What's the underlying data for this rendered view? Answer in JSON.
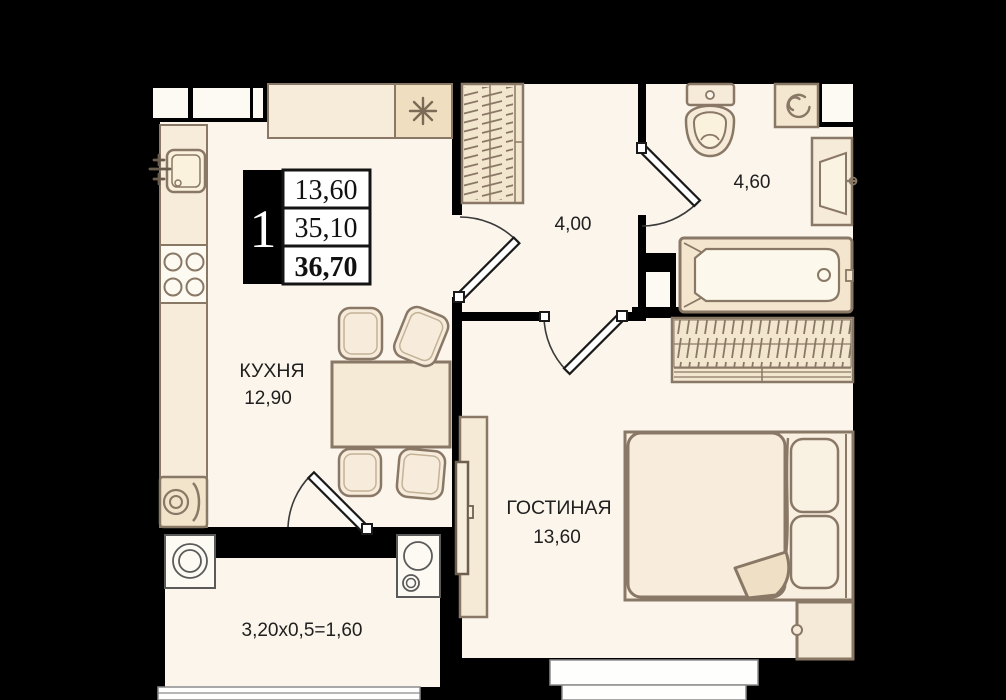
{
  "title": "1-room apartment floor plan",
  "badge": {
    "rooms_count": "1",
    "living_area": "13,60",
    "apartment_area": "35,10",
    "total_area": "36,70"
  },
  "kitchen": {
    "label": "КУХНЯ",
    "area": "12,90"
  },
  "hallway": {
    "area": "4,00"
  },
  "bathroom": {
    "area": "4,60"
  },
  "living_room": {
    "label": "ГОСТИНАЯ",
    "area": "13,60"
  },
  "balcony": {
    "area_formula": "3,20x0,5=1,60"
  },
  "icons": {
    "vent": "asterisk-vent-icon",
    "washer": "washing-machine-spiral-icon",
    "sink": "kitchen-sink-icon",
    "stove": "stove-4-burners-icon",
    "toilet": "toilet-icon",
    "bathtub": "bathtub-icon",
    "bed": "double-bed-icon",
    "wardrobe": "wardrobe-hatch-icon",
    "tv": "tv-stand-icon"
  },
  "colors": {
    "background": "#000000",
    "floor": "#FBF5EB",
    "floor_bright": "#FDFAF4",
    "furniture_fill": "#F7ECDA",
    "furniture_fill_dark": "#EFDEC0",
    "furniture_stroke": "#8A7866",
    "wall": "#000000",
    "text": "#1F1F1F",
    "window_line": "#8C8C8C"
  }
}
